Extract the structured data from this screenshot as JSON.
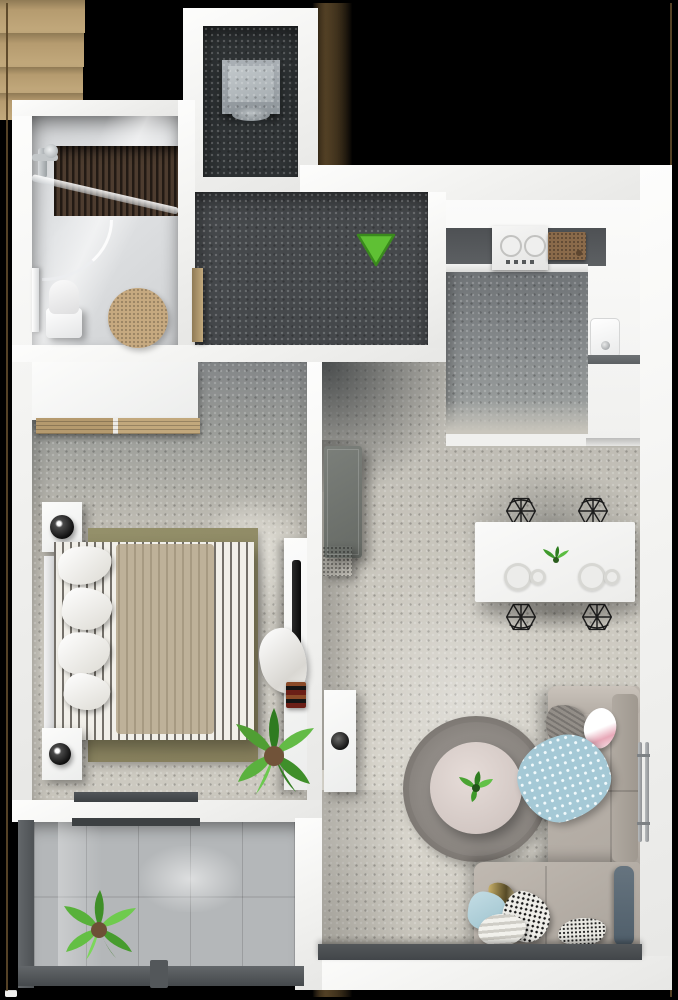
{
  "scene": {
    "type": "3d-floor-plan-render",
    "description": "Top-down 3D render of a one-bedroom apartment with open-plan kitchen/living room, bathroom, entrance hall, storage room and balcony, on a black background",
    "background": "#000000"
  },
  "colors": {
    "background": "#000000",
    "wall": "#f5f5f4",
    "hall_floor": "#45484b",
    "storage_floor": "#2f3335",
    "kitchen_floor": "#84888a",
    "living_floor": "#c8c5bc",
    "bedroom_floor_dark": "#8f918e",
    "bedroom_floor_light": "#d6d3ca",
    "balcony_tile": "#b4b7b9",
    "door_wood": "#b59b6f",
    "entrance_arrow": "#5fc034",
    "entrance_arrow_border": "#3a8a1d",
    "sofa": "#b7b0a8",
    "bed_rug_olive": "#8d8862",
    "round_rug": "#8b8681",
    "coffee_table": "#ddd2ce",
    "shower_wood": "#43352b",
    "bath_mat": "#c6a980",
    "blanket_blue": "#a5c9d6",
    "cushion_slate": "#5f6c78",
    "tv_cabinet": "#70746f",
    "window_glass": "#4b4f52"
  },
  "entrance": {
    "marker": "green-arrow-down-icon",
    "meaning": "apartment entrance direction"
  },
  "rooms": [
    {
      "id": "storage",
      "label": "Storage / laundry room",
      "furniture": [
        "washing-machine"
      ]
    },
    {
      "id": "bathroom",
      "label": "Bathroom",
      "furniture": [
        "walk-in-shower-with-wood-deck",
        "shower-faucet",
        "curved-glass-screen",
        "toilet",
        "round-bath-mat",
        "towel-rail"
      ]
    },
    {
      "id": "hallway",
      "label": "Entrance hall",
      "furniture": [
        "entrance-door",
        "storage-room-door",
        "bathroom-door",
        "bedroom-door",
        "living-room-door",
        "entrance-arrow-marker"
      ]
    },
    {
      "id": "kitchen",
      "label": "Kitchen",
      "furniture": [
        "countertop",
        "cooktop-with-knobs",
        "cutting-board",
        "tall-cabinets",
        "sink-with-faucet"
      ]
    },
    {
      "id": "bedroom",
      "label": "Bedroom",
      "furniture": [
        "wardrobe",
        "wardrobe-wood-shelf",
        "nightstand-upper",
        "lamp-upper",
        "double-bed-striped-duvet",
        "pillows",
        "olive-area-rug",
        "shag-rug",
        "nightstand-lower",
        "lamp-lower",
        "wall-desk",
        "tv",
        "clothes-pile",
        "books",
        "potted-palm",
        "balcony-sliding-door"
      ]
    },
    {
      "id": "living-room",
      "label": "Living room",
      "furniture": [
        "tv-cabinet",
        "media-box",
        "white-sideboard",
        "decor-bowl",
        "dining-table",
        "dining-chair x4",
        "place-setting x2",
        "table-plant",
        "round-rug",
        "round-coffee-table",
        "coffee-table-plant",
        "corner-sofa",
        "armrest",
        "knit-pillow",
        "pink-pillow",
        "polka-dot-blanket",
        "slate-cushion",
        "gold-pillow",
        "light-blue-pillow",
        "striped-pillow",
        "patterned-pillow",
        "dotted-pillow",
        "wall-radiator",
        "panoramic-window-sill"
      ]
    },
    {
      "id": "balcony",
      "label": "Balcony",
      "furniture": [
        "tile-floor",
        "railing-left",
        "railing-bottom",
        "railing-post",
        "door-threshold",
        "potted-plant"
      ]
    }
  ]
}
